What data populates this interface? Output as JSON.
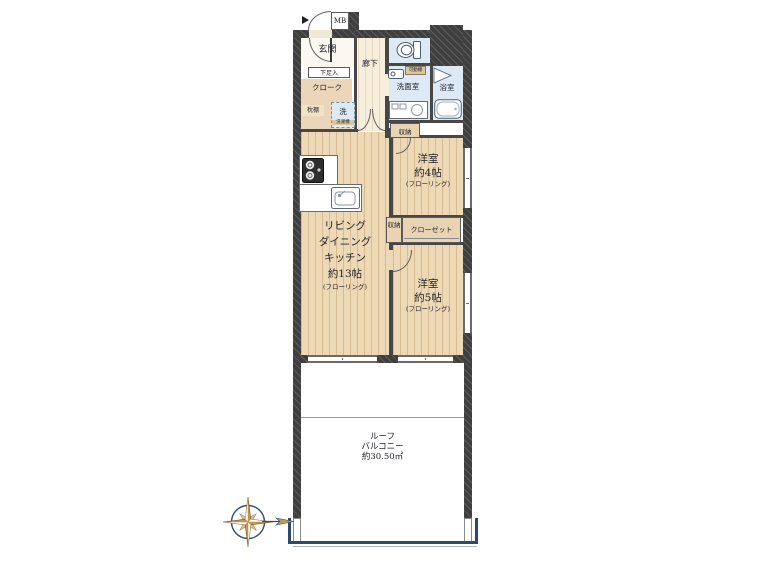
{
  "plan": {
    "mb": "MB",
    "entrance": "玄関",
    "shoe_cabinet": "下足入",
    "cloakroom": "クローク",
    "pillow_shelf": "枕棚",
    "laundry": "洗",
    "laundry_note": "洗濯機",
    "corridor": "廊下",
    "washroom": "洗面室",
    "bathroom": "浴室",
    "movable_shelf": "可動棚",
    "storage_hall": "収納",
    "storage_closet": "収納",
    "closet": "クローゼット",
    "western_room_4": {
      "name": "洋室",
      "size": "約4帖",
      "floor_note": "(フローリング)"
    },
    "western_room_5": {
      "name": "洋室",
      "size": "約5帖",
      "floor_note": "(フローリング)"
    },
    "ldk": {
      "line1": "リビング",
      "line2": "ダイニング",
      "line3": "キッチン",
      "size": "約13帖",
      "floor_note": "(フローリング)"
    },
    "roof_balcony": {
      "line1": "ルーフ",
      "line2": "バルコニー",
      "size": "約30.50㎡"
    }
  },
  "icons": [
    "compass-rose-icon",
    "toilet-icon",
    "bathtub-icon",
    "washbasin-icon",
    "vanity-icon",
    "stove-icon",
    "kitchen-sink-icon",
    "folding-door-icon"
  ],
  "colors": {
    "wall": "#3f3f3f",
    "floor_wood": "#eed9b6",
    "floor_hall": "#f7efdc",
    "wet_area": "#dde9f4",
    "storage_tan": "#e8d3b3",
    "railing_navy": "#2c4a6b",
    "compass_gold": "#c69a4e"
  }
}
